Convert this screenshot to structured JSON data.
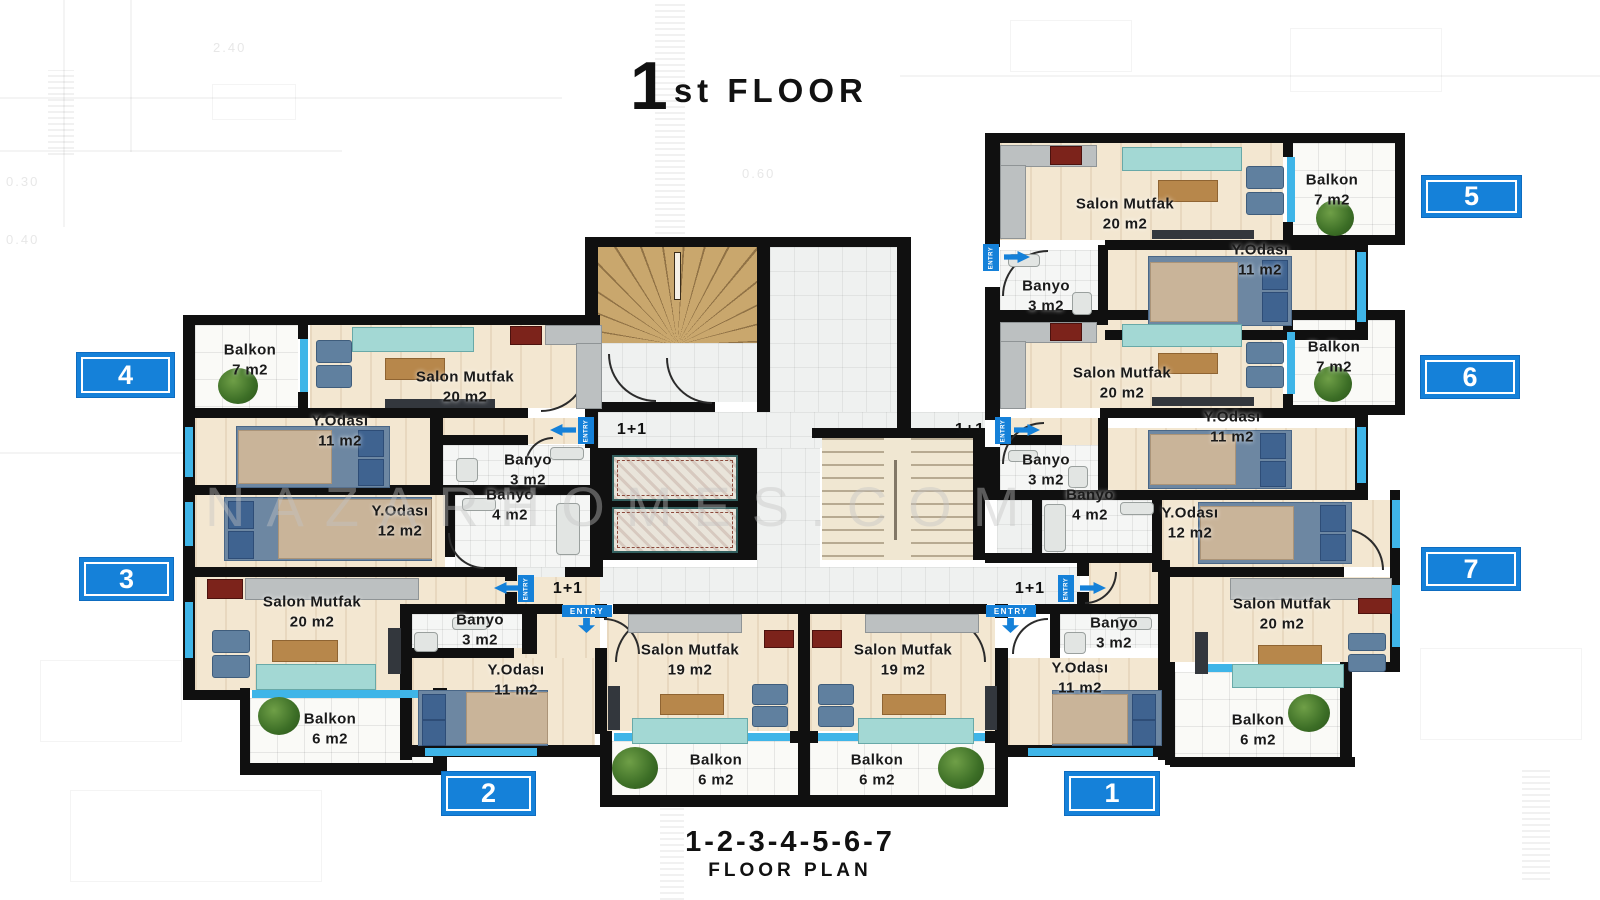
{
  "title": {
    "number": "1",
    "suffix": "st FLOOR"
  },
  "watermark": "NAZARHOMES.COM",
  "footer": {
    "units": "1-2-3-4-5-6-7",
    "caption": "FLOOR PLAN"
  },
  "badges": {
    "b1": "1",
    "b2": "2",
    "b3": "3",
    "b4": "4",
    "b5": "5",
    "b6": "6",
    "b7": "7"
  },
  "markers": {
    "entry": "ENTRY",
    "unit_type": "1+1"
  },
  "background_dims": {
    "d1": "2.40",
    "d2": "0.60",
    "d3": "0.30",
    "d4": "0.40"
  },
  "colors": {
    "accent_blue": "#1581d9",
    "window_cyan": "#3fb5e8",
    "wall": "#101010"
  },
  "rooms": {
    "a4_balkon": {
      "name": "Balkon",
      "area": "7 m2"
    },
    "a4_salon": {
      "name": "Salon Mutfak",
      "area": "20 m2"
    },
    "a4_yodasi": {
      "name": "Y.Odası",
      "area": "11 m2"
    },
    "a4_banyo": {
      "name": "Banyo",
      "area": "3 m2"
    },
    "a3_banyo": {
      "name": "Banyo",
      "area": "4 m2"
    },
    "a3_yodasi": {
      "name": "Y.Odası",
      "area": "12 m2"
    },
    "a3_salon": {
      "name": "Salon Mutfak",
      "area": "20 m2"
    },
    "a3_balkon": {
      "name": "Balkon",
      "area": "6 m2"
    },
    "a2_banyo": {
      "name": "Banyo",
      "area": "3 m2"
    },
    "a2_yodasi": {
      "name": "Y.Odası",
      "area": "11 m2"
    },
    "a2_salon": {
      "name": "Salon Mutfak",
      "area": "19 m2"
    },
    "a2_balkon": {
      "name": "Balkon",
      "area": "6 m2"
    },
    "a1_salon": {
      "name": "Salon Mutfak",
      "area": "19 m2"
    },
    "a1_banyo": {
      "name": "Banyo",
      "area": "3 m2"
    },
    "a1_yodasi": {
      "name": "Y.Odası",
      "area": "11 m2"
    },
    "a1_balkon": {
      "name": "Balkon",
      "area": "6 m2"
    },
    "a5_salon": {
      "name": "Salon Mutfak",
      "area": "20 m2"
    },
    "a5_balkon": {
      "name": "Balkon",
      "area": "7 m2"
    },
    "a5_yodasi": {
      "name": "Y.Odası",
      "area": "11 m2"
    },
    "a5_banyo": {
      "name": "Banyo",
      "area": "3 m2"
    },
    "a6_salon": {
      "name": "Salon Mutfak",
      "area": "20 m2"
    },
    "a6_balkon": {
      "name": "Balkon",
      "area": "7 m2"
    },
    "a6_yodasi": {
      "name": "Y.Odası",
      "area": "11 m2"
    },
    "a6_banyo": {
      "name": "Banyo",
      "area": "3 m2"
    },
    "a7_banyo": {
      "name": "Banyo",
      "area": "4 m2"
    },
    "a7_yodasi": {
      "name": "Y.Odası",
      "area": "12 m2"
    },
    "a7_salon": {
      "name": "Salon Mutfak",
      "area": "20 m2"
    },
    "a7_balkon": {
      "name": "Balkon",
      "area": "6 m2"
    }
  }
}
